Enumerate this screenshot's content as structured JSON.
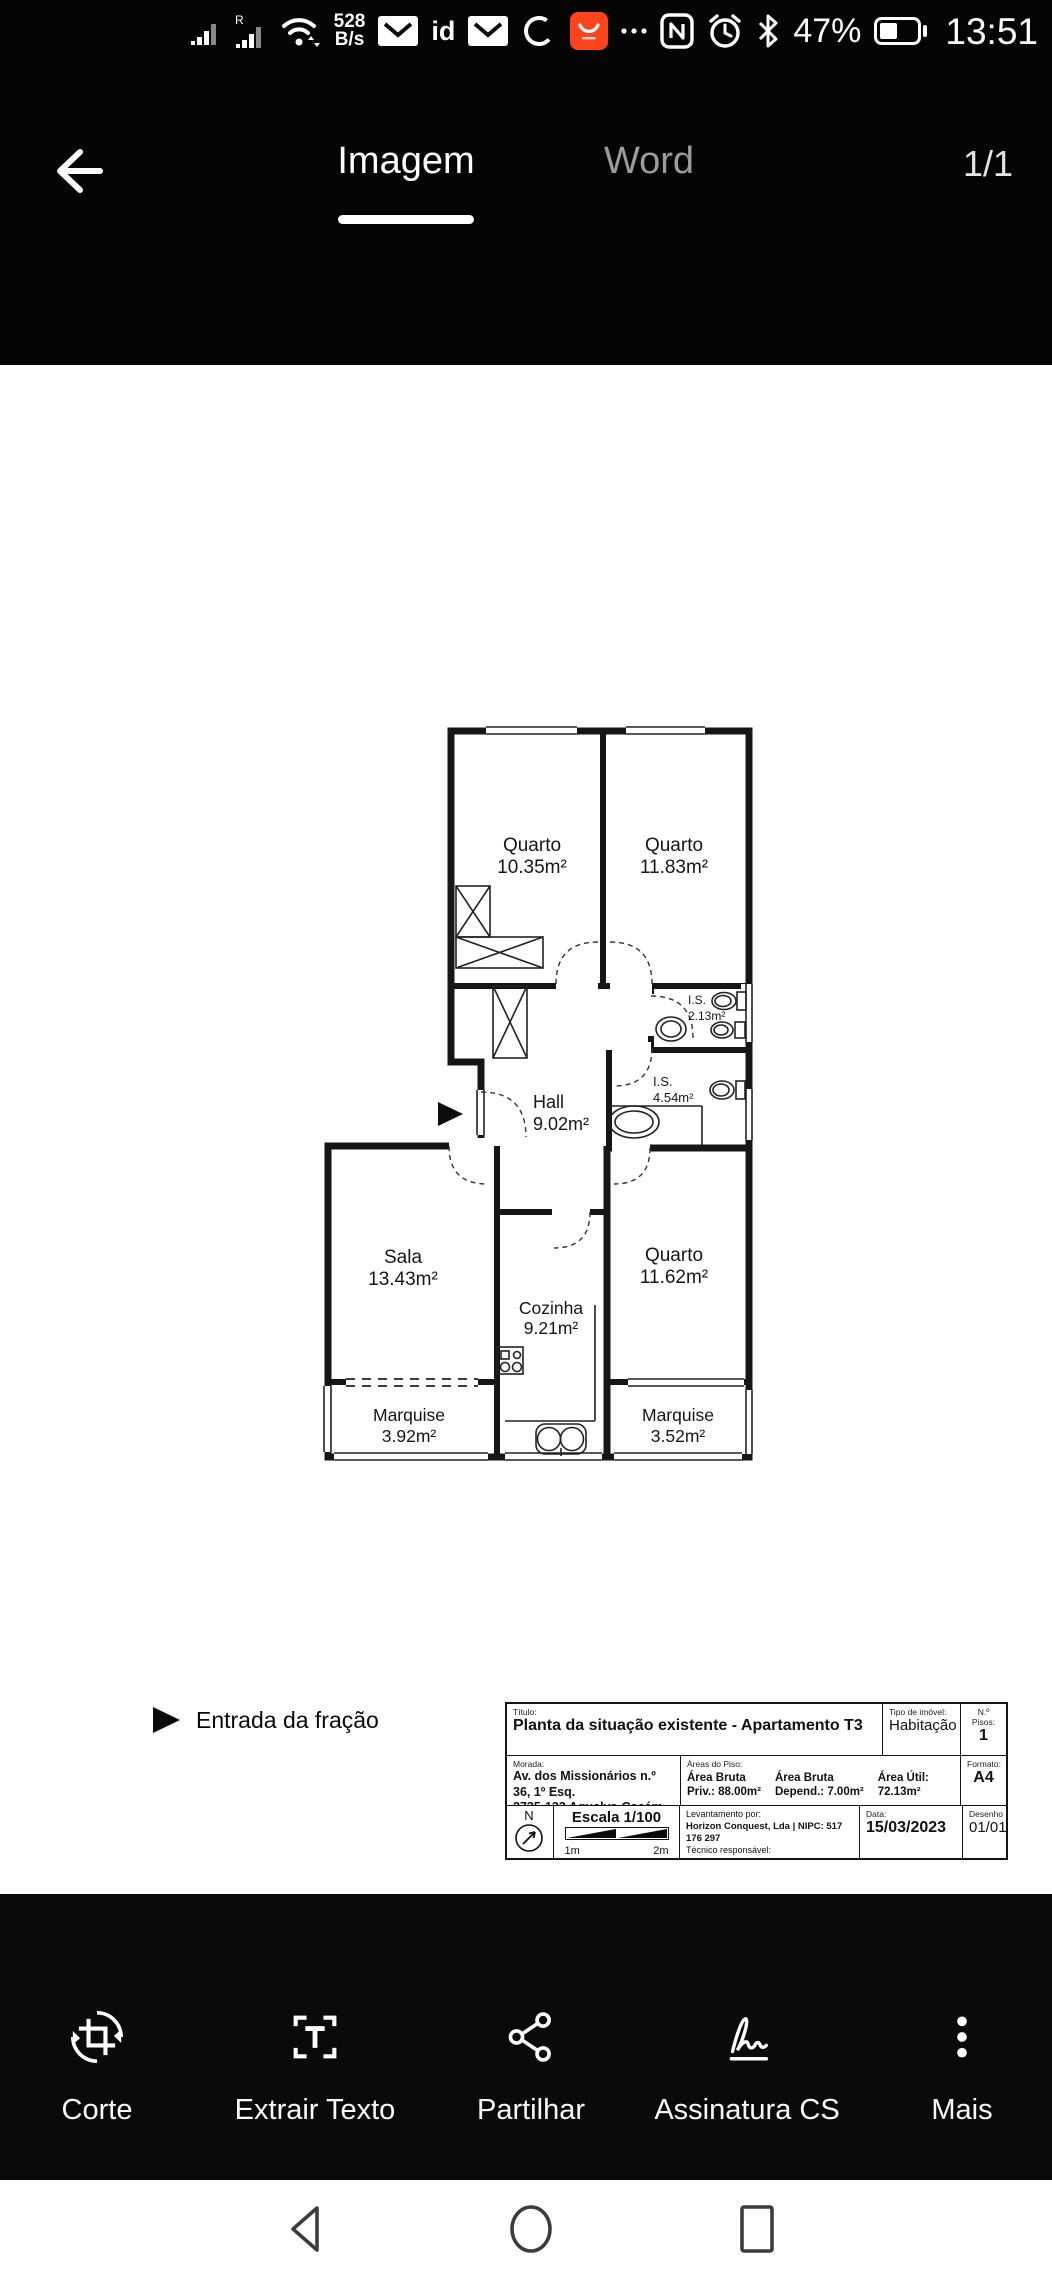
{
  "status_bar": {
    "time": "13:51",
    "battery_percent": "47%",
    "net_speed_value": "528",
    "net_speed_unit": "B/s",
    "sim2_badge": "R",
    "id_label": "id",
    "icons": [
      "signal",
      "signal-r",
      "wifi",
      "mail",
      "id",
      "mail",
      "sync",
      "aliexpress-badge",
      "overflow-dots",
      "nfc",
      "alarm-clock",
      "bluetooth",
      "battery"
    ]
  },
  "header": {
    "back_icon": "arrow-left",
    "tab_imagem": "Imagem",
    "tab_word": "Word",
    "page_indicator": "1/1"
  },
  "plan": {
    "rooms": [
      {
        "name": "Quarto",
        "area": "10.35m²"
      },
      {
        "name": "Quarto",
        "area": "11.83m²"
      },
      {
        "name": "I.S.",
        "area": "2.13m²"
      },
      {
        "name": "I.S.",
        "area": "4.54m²"
      },
      {
        "name": "Hall",
        "area": "9.02m²"
      },
      {
        "name": "Sala",
        "area": "13.43m²"
      },
      {
        "name": "Cozinha",
        "area": "9.21m²"
      },
      {
        "name": "Quarto",
        "area": "11.62m²"
      },
      {
        "name": "Marquise",
        "area": "3.92m²"
      },
      {
        "name": "Marquise",
        "area": "3.52m²"
      }
    ],
    "legend_entrance": "Entrada da fração"
  },
  "title_block": {
    "titulo_label": "Título:",
    "titulo": "Planta da situação existente - Apartamento T3",
    "tipo_label": "Tipo de imóvel:",
    "tipo": "Habitação",
    "pisos_label": "N.º Pisos:",
    "pisos": "1",
    "morada_label": "Morada:",
    "morada_line1": "Av. dos Missionários n.º 36, 1º Esq.",
    "morada_line2": "2735-133 Agualva-Cacém, Sintra",
    "areas_label": "Áreas do Piso:",
    "area1_line1": "Área Bruta",
    "area1_line2": "Priv.: 88.00m²",
    "area2_line1": "Área Bruta",
    "area2_line2": "Depend.: 7.00m²",
    "area3_line1": "Área Útil:",
    "area3_line2": "72.13m²",
    "formato_label": "Formato:",
    "formato": "A4",
    "north_letter": "N",
    "escala": "Escala 1/100",
    "scale_1m": "1m",
    "scale_2m": "2m",
    "lev_label": "Levantamento por:",
    "lev_line1": "Horizon Conquest, Lda | NIPC: 517 176 297",
    "lev_line2": "Técnico responsável:",
    "lev_line3": "Arq. Urb. Rúben Baptista",
    "data_label": "Data:",
    "data_value": "15/03/2023",
    "desenho_label": "Desenho",
    "desenho": "01/01"
  },
  "toolbar": {
    "items": [
      {
        "label": "Corte",
        "icon": "crop-rotate-icon"
      },
      {
        "label": "Extrair Texto",
        "icon": "extract-text-icon"
      },
      {
        "label": "Partilhar",
        "icon": "share-icon"
      },
      {
        "label": "Assinatura CS",
        "icon": "signature-icon"
      },
      {
        "label": "Mais",
        "icon": "more-vertical-icon"
      }
    ]
  },
  "colors": {
    "app_badge_red": "#ff431d",
    "header_bg": "#050505",
    "canvas_bg": "#ffffff"
  }
}
